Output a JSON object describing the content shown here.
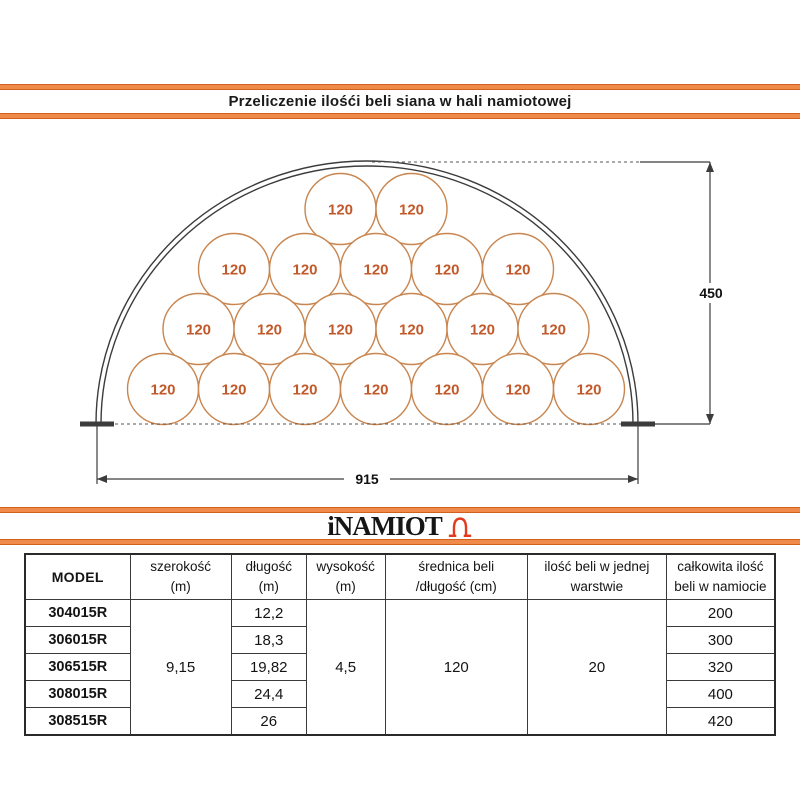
{
  "title": "Przeliczenie ilośći beli siana w hali namiotowej",
  "logo": {
    "text": "iNAMIOT",
    "icon": "tent-icon"
  },
  "diagram": {
    "bale_label": "120",
    "bale_rows_top_to_bottom": [
      2,
      5,
      6,
      7
    ],
    "bales_per_layer_total": 20,
    "height_label": "450",
    "width_label": "915",
    "colors": {
      "accent_orange": "#f08a4a",
      "accent_orange_dark": "#d2601e",
      "bale_stroke": "#c8854f",
      "bale_text": "#c2592a",
      "frame_line": "#3c3c3c",
      "logo_icon_red": "#e23b1e"
    }
  },
  "table": {
    "headers": [
      {
        "lines": [
          "MODEL"
        ]
      },
      {
        "lines": [
          "szerokość",
          "(m)"
        ]
      },
      {
        "lines": [
          "długość",
          "(m)"
        ]
      },
      {
        "lines": [
          "wysokość",
          "(m)"
        ]
      },
      {
        "lines": [
          "średnica beli",
          "/długość (cm)"
        ]
      },
      {
        "lines": [
          "ilość beli w jednej",
          "warstwie"
        ]
      },
      {
        "lines": [
          "całkowita ilość",
          "beli w namiocie"
        ]
      }
    ],
    "merged": {
      "szerokosc": "9,15",
      "wysokosc": "4,5",
      "srednica": "120",
      "warstwa": "20"
    },
    "rows": [
      {
        "model": "304015R",
        "dlugosc": "12,2",
        "total": "200"
      },
      {
        "model": "306015R",
        "dlugosc": "18,3",
        "total": "300"
      },
      {
        "model": "306515R",
        "dlugosc": "19,82",
        "total": "320"
      },
      {
        "model": "308015R",
        "dlugosc": "24,4",
        "total": "400"
      },
      {
        "model": "308515R",
        "dlugosc": "26",
        "total": "420"
      }
    ]
  }
}
